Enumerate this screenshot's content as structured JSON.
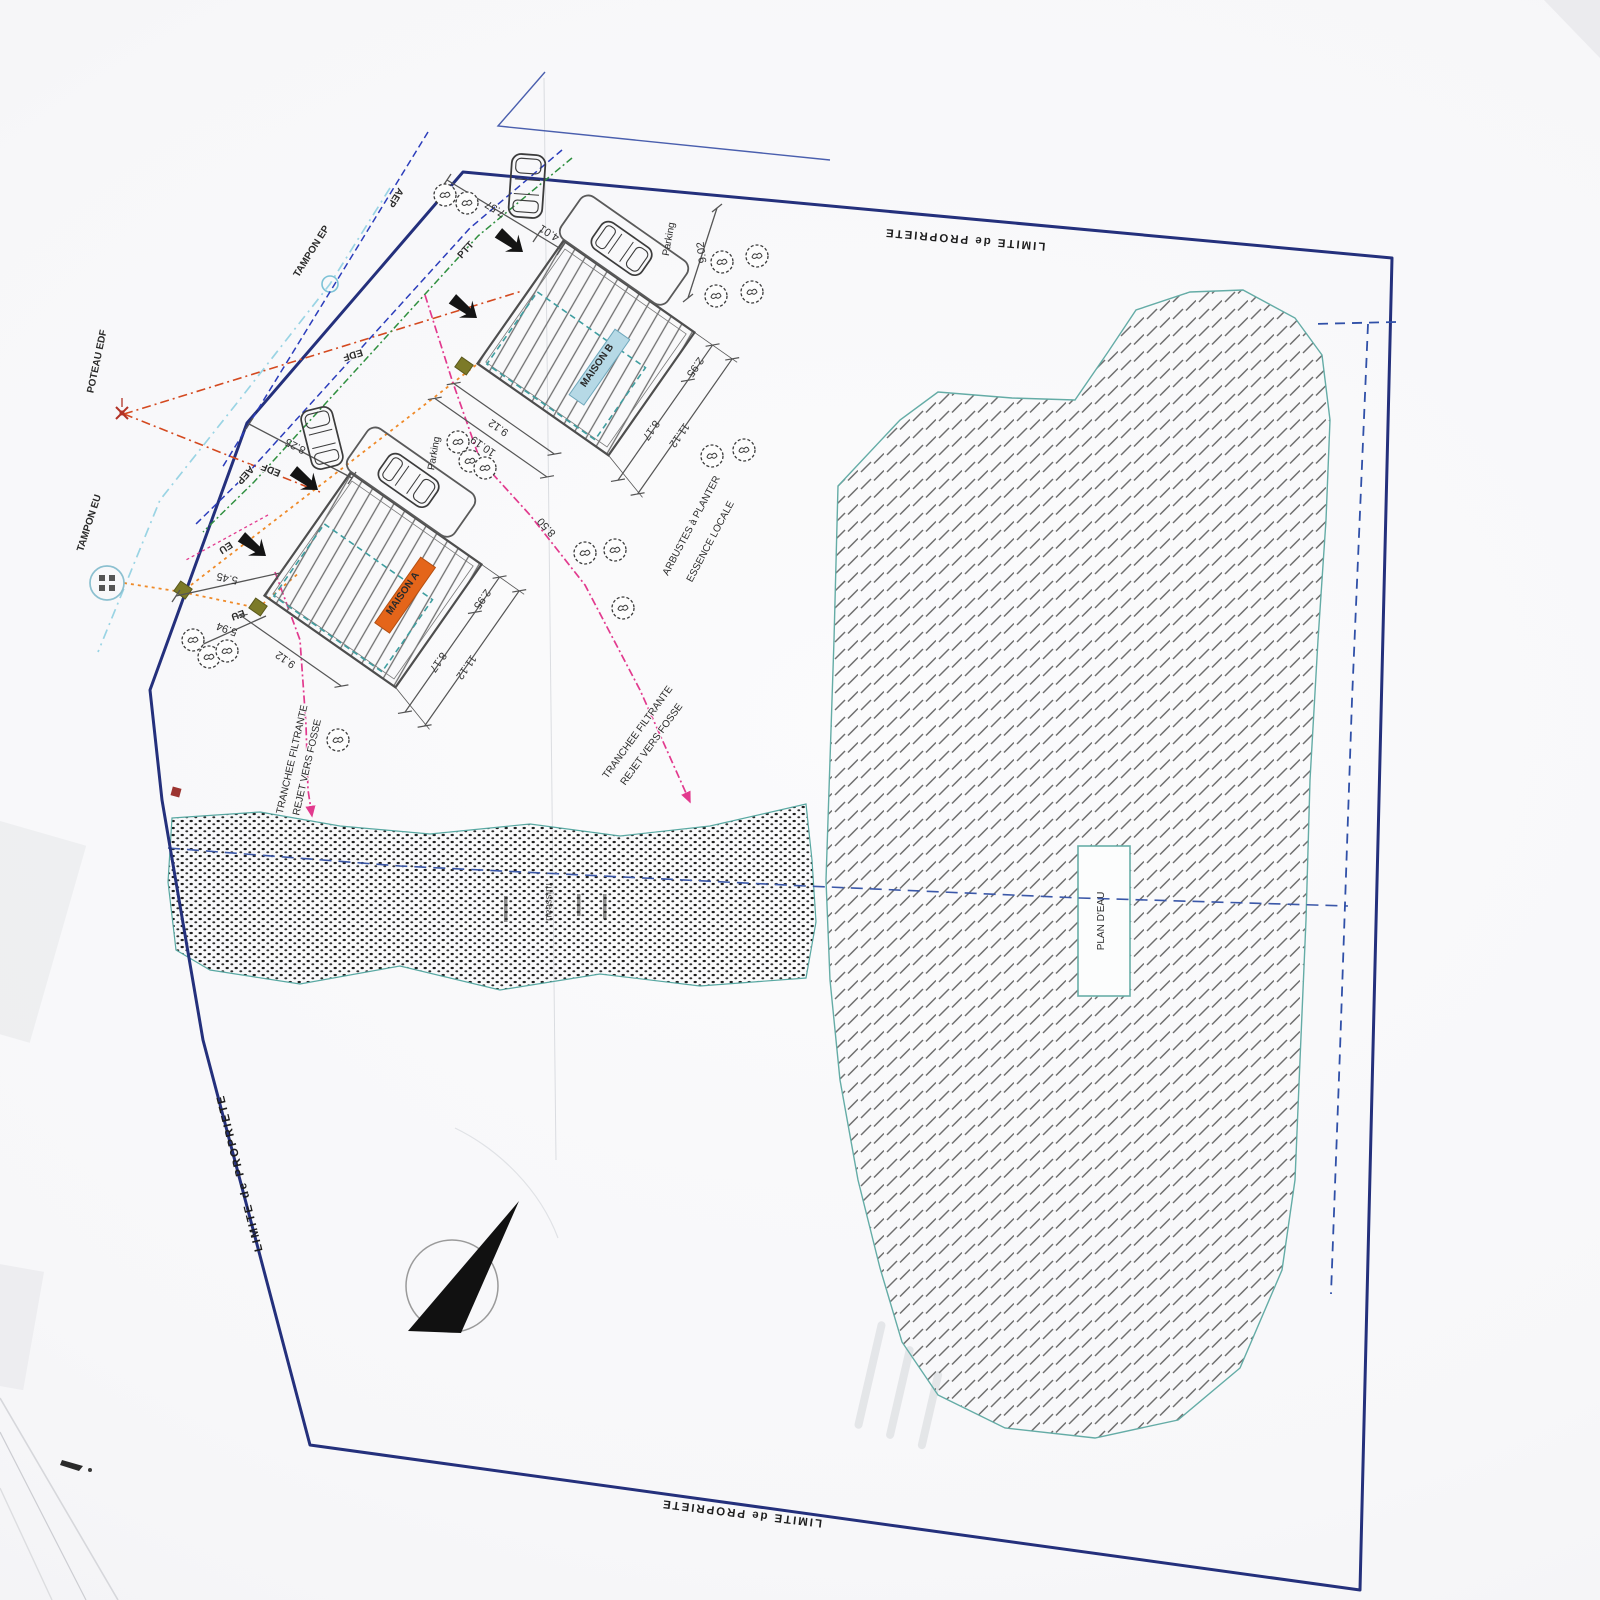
{
  "plan": {
    "boundary_label": "LIMITE de PROPRIETE"
  },
  "houses": {
    "a": {
      "label": "MAISON A"
    },
    "b": {
      "label": "MAISON B"
    },
    "parking_label": "Parking"
  },
  "dimensions": {
    "front_1": "7.57",
    "front_2": "4.01",
    "road": "9.02",
    "terrace": "2.95",
    "depth_main": "8.17",
    "depth_total": "11.12",
    "width": "9.12",
    "width_outer": "10.19",
    "a_front": "8.25",
    "a_side1": "5.45",
    "a_side2": "5.94",
    "gap": "8.50"
  },
  "utilities": {
    "tampon_ep": "TAMPON EP",
    "poteau_edf": "POTEAU EDF",
    "tampon_eu": "TAMPON EU",
    "edf": "EDF",
    "eu": "EU",
    "aep": "AEP",
    "ptt": "PTT"
  },
  "sanitation": {
    "trench_line1": "TRANCHEE FILTRANTE",
    "trench_line2": "REJET VERS FOSSE"
  },
  "landscape": {
    "shrubs_line1": "ARBUSTES à PLANTER",
    "shrubs_line2": "ESSENCE LOCALE",
    "pond_label": "PLAN D'EAU",
    "stream_label": "ruisseau"
  },
  "colors": {
    "boundary": "#24307c",
    "water_edge": "#5ba49e",
    "trench": "#e23a8e",
    "edf_line": "#d4491f",
    "eu_line": "#ef8a28",
    "aep_line": "#2b3dbb",
    "ptt_line": "#2f8f3f",
    "ep_line": "#9ad4e4",
    "maison_a_fill": "#e4651a",
    "maison_b_fill": "#b6d9e6"
  }
}
